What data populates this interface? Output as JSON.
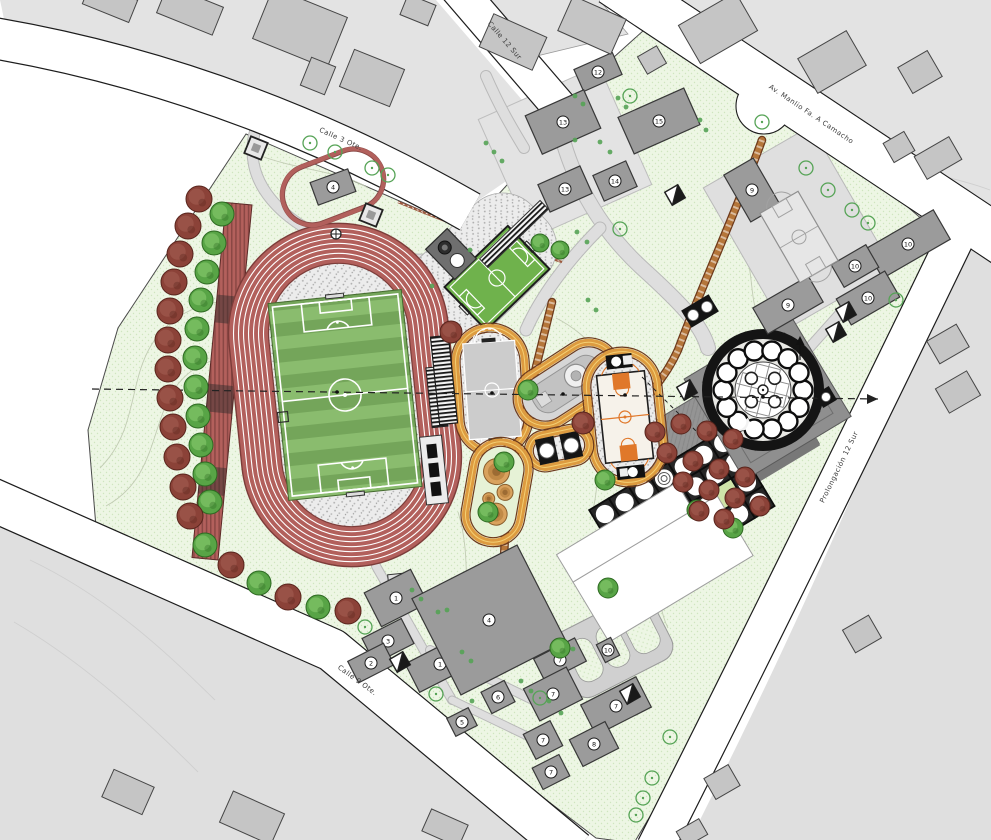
{
  "streets": [
    {
      "id": "calle-3-ote",
      "name": "Calle 3 Ote."
    },
    {
      "id": "calle-12-sur",
      "name": "Calle 12 Sur"
    },
    {
      "id": "av-manlio-camacho",
      "name": "Av. Manlio Fa. A Camacho"
    },
    {
      "id": "prolongacion-12-sur",
      "name": "Prolongación 12 Sur"
    },
    {
      "id": "calle-9-ote",
      "name": "Calle 9 Ote."
    }
  ],
  "buildings": [
    {
      "id": "b1a",
      "label": "1"
    },
    {
      "id": "b3",
      "label": "3"
    },
    {
      "id": "b2",
      "label": "2"
    },
    {
      "id": "b1b",
      "label": "1"
    },
    {
      "id": "b4",
      "label": "4"
    },
    {
      "id": "b6",
      "label": "6"
    },
    {
      "id": "b5",
      "label": "5"
    },
    {
      "id": "b7a",
      "label": "7"
    },
    {
      "id": "b7b",
      "label": "7"
    },
    {
      "id": "b7c",
      "label": "7"
    },
    {
      "id": "b7d",
      "label": "7"
    },
    {
      "id": "b7e",
      "label": "7"
    },
    {
      "id": "b8",
      "label": "8"
    },
    {
      "id": "b10p",
      "label": "10"
    },
    {
      "id": "b12",
      "label": "12"
    },
    {
      "id": "b13a",
      "label": "13"
    },
    {
      "id": "b13b",
      "label": "13"
    },
    {
      "id": "b14",
      "label": "14"
    },
    {
      "id": "b15",
      "label": "15"
    },
    {
      "id": "b9a",
      "label": "9"
    },
    {
      "id": "b9b",
      "label": "9"
    },
    {
      "id": "b10a",
      "label": "10"
    },
    {
      "id": "b10b",
      "label": "10"
    },
    {
      "id": "b10c",
      "label": "10"
    },
    {
      "id": "b4m",
      "label": "4"
    }
  ],
  "palette": {
    "paper": "#ffffff",
    "block": "#e3e3e3",
    "block2": "#dfdfdf",
    "context_building": "#c5c5c5",
    "context_building_stroke": "#454545",
    "street_edge": "#1c1c1c",
    "lawn": "#edf6e4",
    "lawn_dot": "#cfe5bf",
    "site_stroke": "#4a4a4a",
    "path": "#dedede",
    "path_edge": "#b9b9b9",
    "contour": "#c2ccb4",
    "contour_gray": "#cfcfcf",
    "track_red": "#b2605c",
    "track_dark": "#7c3c39",
    "lane": "#ffffff",
    "gravel": "#ececec",
    "field_dark": "#74a55a",
    "field_light": "#8abc6e",
    "marking": "#ffffff",
    "mini_green": "#6fb24c",
    "ring_band": "#dd9b40",
    "ring_edge": "#6d3a1c",
    "ring_inner": "#f3cf73",
    "court_gray": "#cccccc",
    "skate_gray": "#d6d6d6",
    "bball_court": "#f6f2ea",
    "bball_orange": "#e0782a",
    "black": "#141414",
    "white": "#ffffff",
    "plaza": "#949494",
    "plaza_dark": "#787878",
    "platform": "#8f8f8f",
    "grid_dark": "#262626",
    "yellow_cell": "#cdd96a",
    "green_cell": "#cfe3a8",
    "tree_green": "#58a446",
    "tree_green_light": "#82c468",
    "tree_green_dark": "#2e6a22",
    "tree_red": "#8b4238",
    "tree_red_light": "#a05a4e",
    "tree_red_dark": "#58241c",
    "ctx_tree": "#55a355",
    "building": "#9b9b9b",
    "building_stroke": "#383838",
    "orange_path": "#b5763a",
    "axis": "#222222",
    "label": "#3d3d3d"
  }
}
